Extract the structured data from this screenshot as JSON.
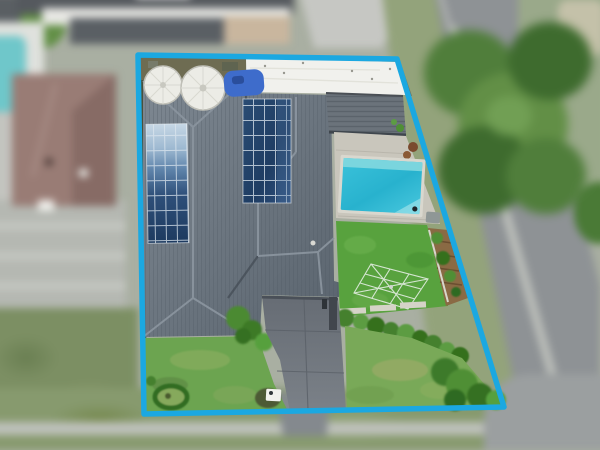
{
  "scene": {
    "kind": "real-estate-aerial-drone-photo",
    "description": "Top-down aerial photograph of a suburban residential lot outlined with a cyan property boundary; house with dark tiled hip roof, two rooftop solar arrays, white flat roof, slatted pergola, swimming pool, lawns, rotary clothesline, concrete driveway; blurred neighbouring houses, street, footpath and trees around it"
  },
  "boundary": {
    "points": "138,55 397,59 504,407 144,414",
    "stroke_width": "5.5"
  },
  "objects": {
    "inside_lot": [
      "main-house-hip-roof",
      "solar-array-left",
      "solar-array-middle",
      "white-flat-roof",
      "pergola-slat-roof",
      "rainwater-tanks",
      "blue-tarp",
      "swimming-pool",
      "pool-paving",
      "back-lawn",
      "rotary-clothesline",
      "garden-bed-mulch",
      "hedge-row",
      "front-lawn-left",
      "front-lawn-right",
      "circular-garden-bed",
      "letterbox",
      "concrete-driveway",
      "garage-wall",
      "shrubs"
    ],
    "outside_lot": [
      "neighbour-house-brown-roof",
      "neighbour-pool",
      "neighbour-driveway",
      "neighbour-lawn",
      "top-neighbour-roofs",
      "street-road",
      "footpath",
      "street-trees",
      "nature-strip",
      "road-corner"
    ]
  },
  "palette": {
    "base_ground": "#A9AFA2",
    "boundary_cyan": "#1BA8E1",
    "roof_light": "#7E8892",
    "roof_dark": "#5A646E",
    "roof_ridge": "#8A949E",
    "roof_valley": "#3F4750",
    "white_roof": "#F1F1ED",
    "pergola": "#6B737B",
    "paving": "#C9C6BC",
    "pool_coping": "#D9D7CE",
    "pool_water": "#2CB9D3",
    "pool_step": "#83D8DF",
    "back_lawn": "#58A23E",
    "front_lawn_left": "#6CA450",
    "front_lawn_right": "#79A958",
    "driveway": "#6E747C",
    "dirt_back": "#6E6C52",
    "side_strip": "#49503B",
    "tank_white": "#ECECE6",
    "tarp_blue": "#3E6CCB",
    "mulch": "#8A6A44",
    "hedge_mid": "#44802F",
    "hedge_light": "#5C9C43",
    "hedge_dark": "#35701F",
    "clothesline_white": "#EDF2ED",
    "neighbor_roof": "#997C75",
    "neighbor_roof_dark": "#826661",
    "neighbor_pool": "#6FC7CA",
    "neighbor_concrete": "#C3C4BF",
    "neighbor_lawn": "#7C8F63",
    "top_roof": "#55595E",
    "white_wall": "#E7E7E3",
    "top_concrete": "#C6C7C3",
    "vehicle_dark": "#3A3F45",
    "road": "#8E9295",
    "curb": "#C2C4BF",
    "footpath": "#BEC1BB",
    "nature_grass": "#93A37B",
    "tree_green": "#507E3B",
    "tree_light": "#628F46",
    "tree_dark": "#3E6B2E",
    "right_grass": "#9AA98A",
    "dirt_patch": "#C4C1A9",
    "bottom_grass": "#879A6E",
    "letterbox_white": "#F2F2EE",
    "utility_box": "#8F9796",
    "pot_brown": "#7A4A2E"
  }
}
